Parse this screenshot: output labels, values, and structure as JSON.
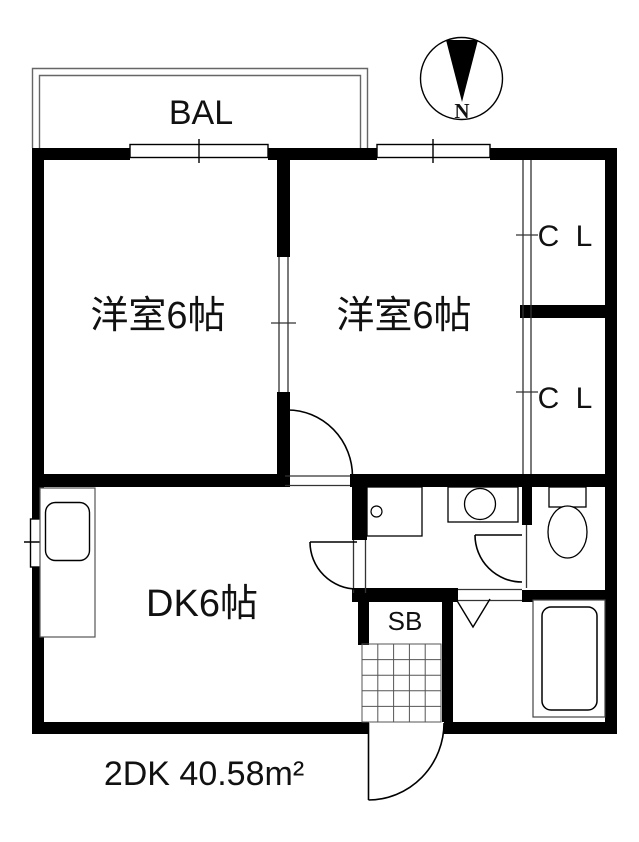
{
  "plan": {
    "area_label": "2DK 40.58m²",
    "balcony": "BAL",
    "room1": "洋室6帖",
    "room2": "洋室6帖",
    "dining_kitchen": "DK6帖",
    "closet_top": "C L",
    "closet_bottom": "C L",
    "shoe_box": "SB",
    "compass_north": "N"
  },
  "colors": {
    "wall": "#000000",
    "background": "#ffffff",
    "thin_line": "#555555",
    "fixture_line": "#000000"
  }
}
